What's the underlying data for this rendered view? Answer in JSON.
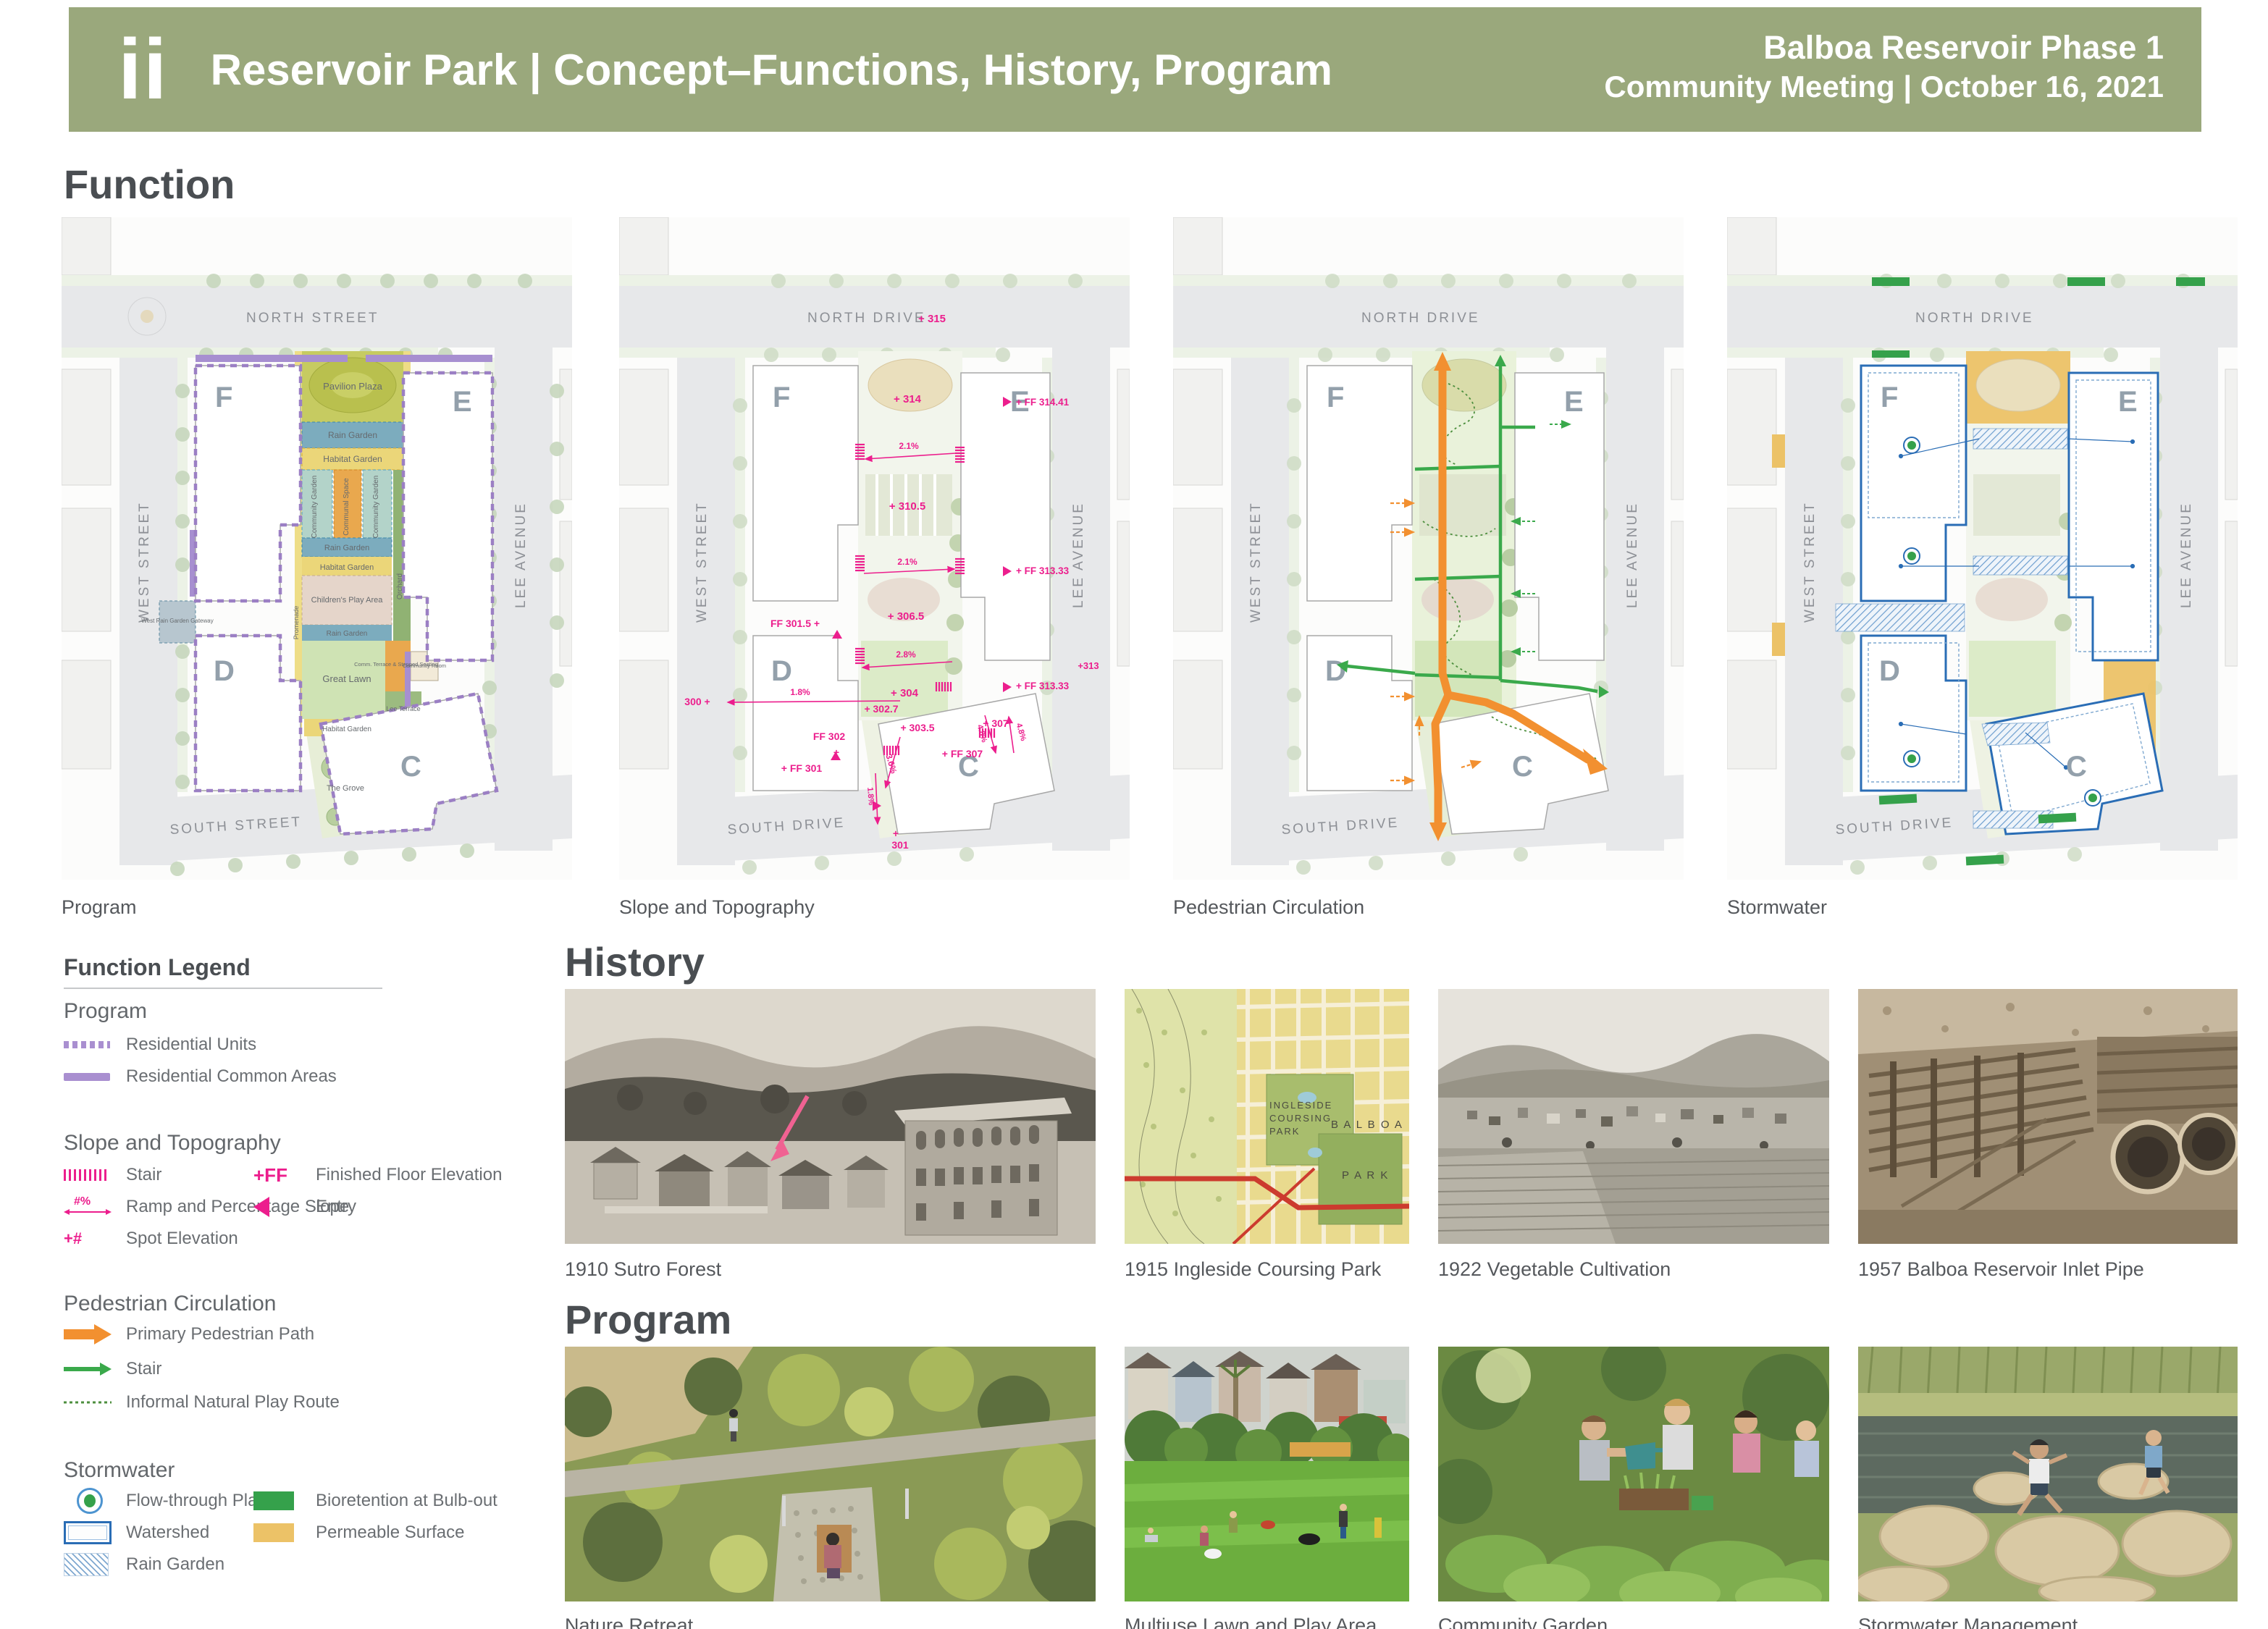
{
  "header": {
    "logo": "ii",
    "title": "Reservoir Park  |  Concept–Functions, History, Program",
    "project": "Balboa Reservoir Phase 1",
    "meeting": "Community Meeting  |  October 16, 2021"
  },
  "function_section": {
    "heading": "Function",
    "map_captions": [
      "Program",
      "Slope and Topography",
      "Pedestrian Circulation",
      "Stormwater"
    ]
  },
  "streets": {
    "north_street": "NORTH STREET",
    "north_drive": "NORTH DRIVE",
    "west_street": "WEST STREET",
    "lee_avenue": "LEE AVENUE",
    "south_street": "SOUTH STREET",
    "south_drive": "SOUTH DRIVE"
  },
  "blocks": {
    "f": "F",
    "e": "E",
    "d": "D",
    "c": "C"
  },
  "program_map_labels": {
    "pavilion": "Pavilion Plaza",
    "rain1": "Rain Garden",
    "habitat1": "Habitat Garden",
    "cg1": "Community Garden",
    "communal": "Communal Space",
    "cg2": "Community Garden",
    "rain2": "Rain Garden",
    "habitat2": "Habitat Garden",
    "play": "Children's Play Area",
    "rain3": "Rain Garden",
    "lawn": "Great Lawn",
    "orchard": "Orchard",
    "promenade": "Promenade",
    "terrace": "Comm. Terrace & Stepped Seating",
    "room": "Community Room",
    "gateway": "West Rain Garden Gateway",
    "habitat3": "Habitat Garden",
    "lee_terrace": "Lee Terrace",
    "grove": "The Grove"
  },
  "topo_map_labels": {
    "e315": "+ 315",
    "e314": "+ 314",
    "ff31441": "+ FF 314.41",
    "s21a": "2.1%",
    "e3105": "+ 310.5",
    "s21b": "2.1%",
    "ff31333a": "+ FF 313.33",
    "e3065": "+ 306.5",
    "s28": "2.8%",
    "ff3015": "FF 301.5 +",
    "e304": "+ 304",
    "ff31333b": "+ FF 313.33",
    "e300": "300 +",
    "s18a": "1.8%",
    "e3027": "+ 302.7",
    "ff302": "FF 302",
    "e3035": "+ 303.5",
    "s36": "3.6%",
    "e307": "+ 307",
    "s48a": "4.8%",
    "s48b": "4.8%",
    "ff307": "+ FF 307",
    "ff301": "+ FF 301",
    "s18b": "1.8%",
    "e313": "+313",
    "e301": "301"
  },
  "legend": {
    "heading": "Function Legend",
    "program_title": "Program",
    "residential_units": "Residential Units",
    "residential_common": "Residential Common Areas",
    "slope_title": "Slope and Topography",
    "stair": "Stair",
    "ramp": "Ramp and Percentage Slope",
    "ramp_symbol": "#%",
    "spot": "Spot Elevation",
    "spot_symbol": "+#",
    "ff_symbol": "+FF",
    "ff": "Finished Floor Elevation",
    "entry": "Entry",
    "ped_title": "Pedestrian Circulation",
    "primary_path": "Primary Pedestrian Path",
    "ped_stair": "Stair",
    "informal": "Informal Natural Play Route",
    "storm_title": "Stormwater",
    "flow_planter": "Flow-through Planter",
    "watershed": "Watershed",
    "rain_garden": "Rain Garden",
    "bioretention": "Bioretention at Bulb-out",
    "permeable": "Permeable Surface"
  },
  "history": {
    "heading": "History",
    "captions": [
      "1910 Sutro Forest",
      "1915 Ingleside Coursing Park",
      "1922 Vegetable Cultivation",
      "1957 Balboa Reservoir Inlet Pipe"
    ],
    "map_text": {
      "l1": "INGLESIDE",
      "l2": "COURSING",
      "l3": "PARK",
      "balboa": "B A L B O A",
      "park": "P A R K"
    }
  },
  "program_section": {
    "heading": "Program",
    "captions": [
      "Nature Retreat",
      "Multiuse Lawn and Play Area",
      "Community Garden",
      "Stormwater Management"
    ]
  },
  "colors": {
    "header_olive": "#9aa87c",
    "annotation_pink": "#ec1e8d",
    "residential_purple": "#a98fd0",
    "path_orange": "#f29030",
    "stair_green": "#3aa94b",
    "stormwater_blue": "#2a6db5",
    "bioretention_green": "#35a14b",
    "permeable_yellow": "#ecc267"
  }
}
